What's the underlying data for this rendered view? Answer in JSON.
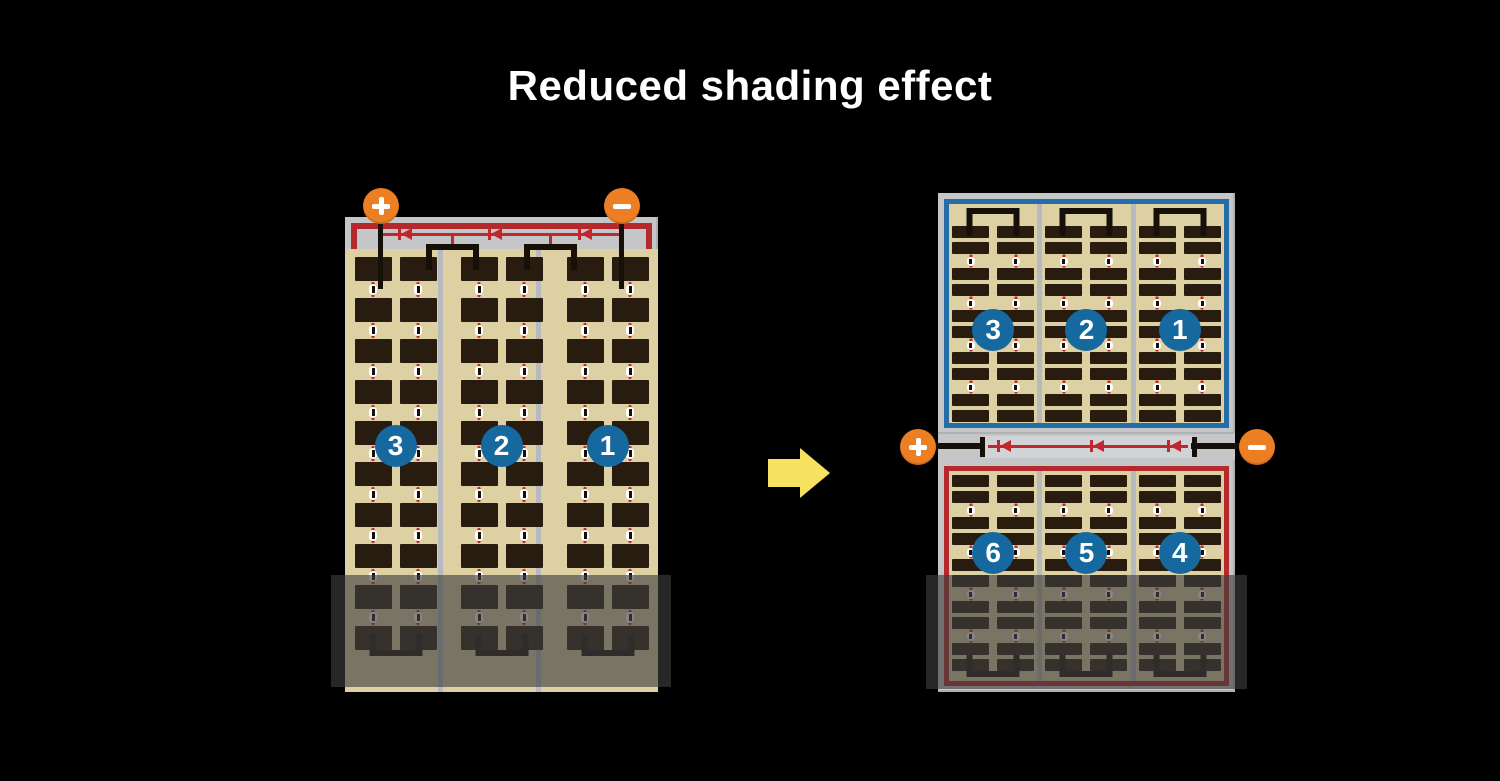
{
  "title": "Reduced shading effect",
  "colors": {
    "background": "#000000",
    "panel_frame": "#c5c6c8",
    "cell_dark": "#281c11",
    "cell_background_tan": "#ddd1a3",
    "string_divider": "#b6b9be",
    "circuit_red": "#b3292c",
    "diode_red": "#c1272d",
    "circuit_blue": "#256da6",
    "badge_blue": "#15699e",
    "terminal_orange": "#ec7e23",
    "arrow_yellow": "#f7e160",
    "wire_black": "#161009",
    "title_white": "#ffffff"
  },
  "left_panel": {
    "terminals": {
      "positive": "+",
      "negative": "−"
    },
    "section_labels": [
      "3",
      "2",
      "1"
    ],
    "structure": {
      "strings": 3,
      "columns_per_string": 2,
      "cell_rows": 10,
      "cell_type": "full-size",
      "bypass_diodes": 3,
      "shaded_region": "bottom"
    }
  },
  "right_panel": {
    "terminals": {
      "positive": "+",
      "negative": "−"
    },
    "top_section_labels": [
      "3",
      "2",
      "1"
    ],
    "bottom_section_labels": [
      "6",
      "5",
      "4"
    ],
    "structure": {
      "strings_per_half": 3,
      "columns_per_string": 2,
      "cell_rows_per_half": 10,
      "cell_type": "half-cut",
      "bypass_diodes": 3,
      "shaded_region": "bottom"
    }
  }
}
